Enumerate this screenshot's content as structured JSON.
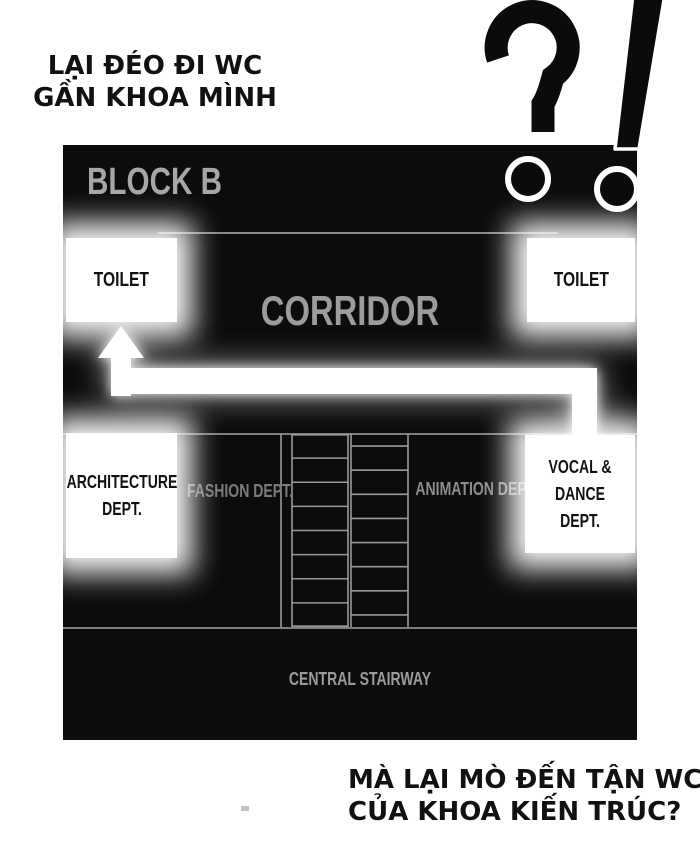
{
  "speech_top": {
    "line1": "LẠI ĐÉO ĐI WC",
    "line2": "GẦN KHOA MÌNH"
  },
  "interjection": "?!",
  "panel": {
    "title": "BLOCK B",
    "corridor_label": "CORRIDOR",
    "toilets": {
      "left": "TOILET",
      "right": "TOILET"
    },
    "departments": {
      "architecture": {
        "line1": "ARCHITECTURE",
        "line2": "DEPT."
      },
      "fashion": "FASHION DEPT.",
      "animation": "ANIMATION DEPT.",
      "vocal_dance": {
        "line1": "VOCAL &",
        "line2": "DANCE DEPT."
      }
    },
    "stairway_label": "CENTRAL STAIRWAY",
    "stairs": {
      "left_rows": 8,
      "right_rows": 8
    },
    "colors": {
      "panel_bg": "#0c0c0c",
      "label_gray": "#9c9c9c",
      "dim_gray": "#7e7e7e",
      "line_gray": "#8a8a8a",
      "room_white": "#ffffff",
      "ink_black": "#0b0b0b"
    }
  },
  "speech_bottom": {
    "line1": "MÀ LẠI MÒ ĐẾN TẬN WC",
    "line2": "CỦA KHOA KIẾN TRÚC?"
  }
}
